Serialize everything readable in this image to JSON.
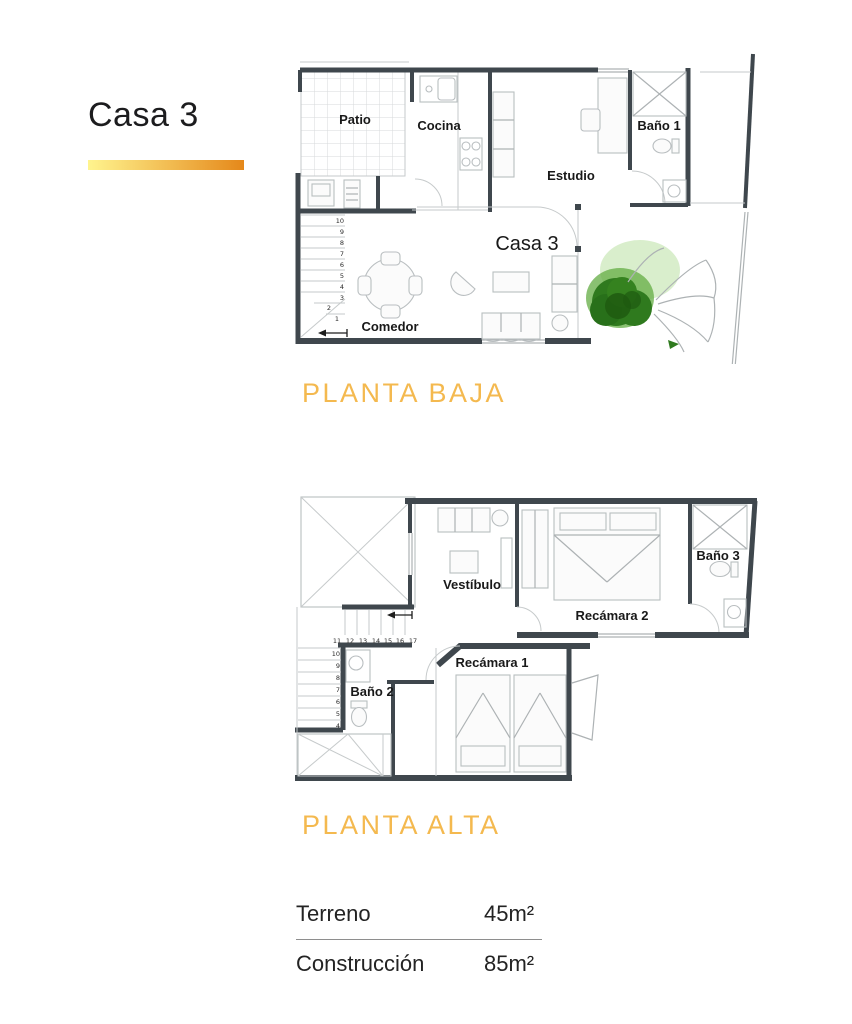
{
  "header": {
    "title": "Casa 3"
  },
  "colors": {
    "accent_from": "#FFF48E",
    "accent_to": "#E5881A",
    "plan_title_gold": "#F4B94F",
    "wall_dark": "#3F474D",
    "tree_green": "#2F7A1E"
  },
  "ground_floor": {
    "caption": "PLANTA BAJA",
    "unit_label": "Casa 3",
    "rooms": {
      "patio": "Patio",
      "cocina": "Cocina",
      "bano1": "Baño 1",
      "estudio": "Estudio",
      "comedor": "Comedor"
    },
    "stairs": [
      "10",
      "9",
      "8",
      "7",
      "6",
      "5",
      "4",
      "3",
      "2",
      "1"
    ]
  },
  "upper_floor": {
    "caption": "PLANTA ALTA",
    "rooms": {
      "vestibulo": "Vestíbulo",
      "recamara2": "Recámara 2",
      "bano3": "Baño 3",
      "bano2": "Baño 2",
      "recamara1": "Recámara 1"
    },
    "stairs_upper_run": [
      "11",
      "12",
      "13",
      "14",
      "15",
      "16",
      "17"
    ],
    "stairs_lower_run": [
      "10",
      "9",
      "8",
      "7",
      "6",
      "5",
      "4"
    ]
  },
  "summary": {
    "rows": [
      {
        "label": "Terreno",
        "value": "45m²"
      },
      {
        "label": "Construcción",
        "value": "85m²"
      }
    ]
  }
}
